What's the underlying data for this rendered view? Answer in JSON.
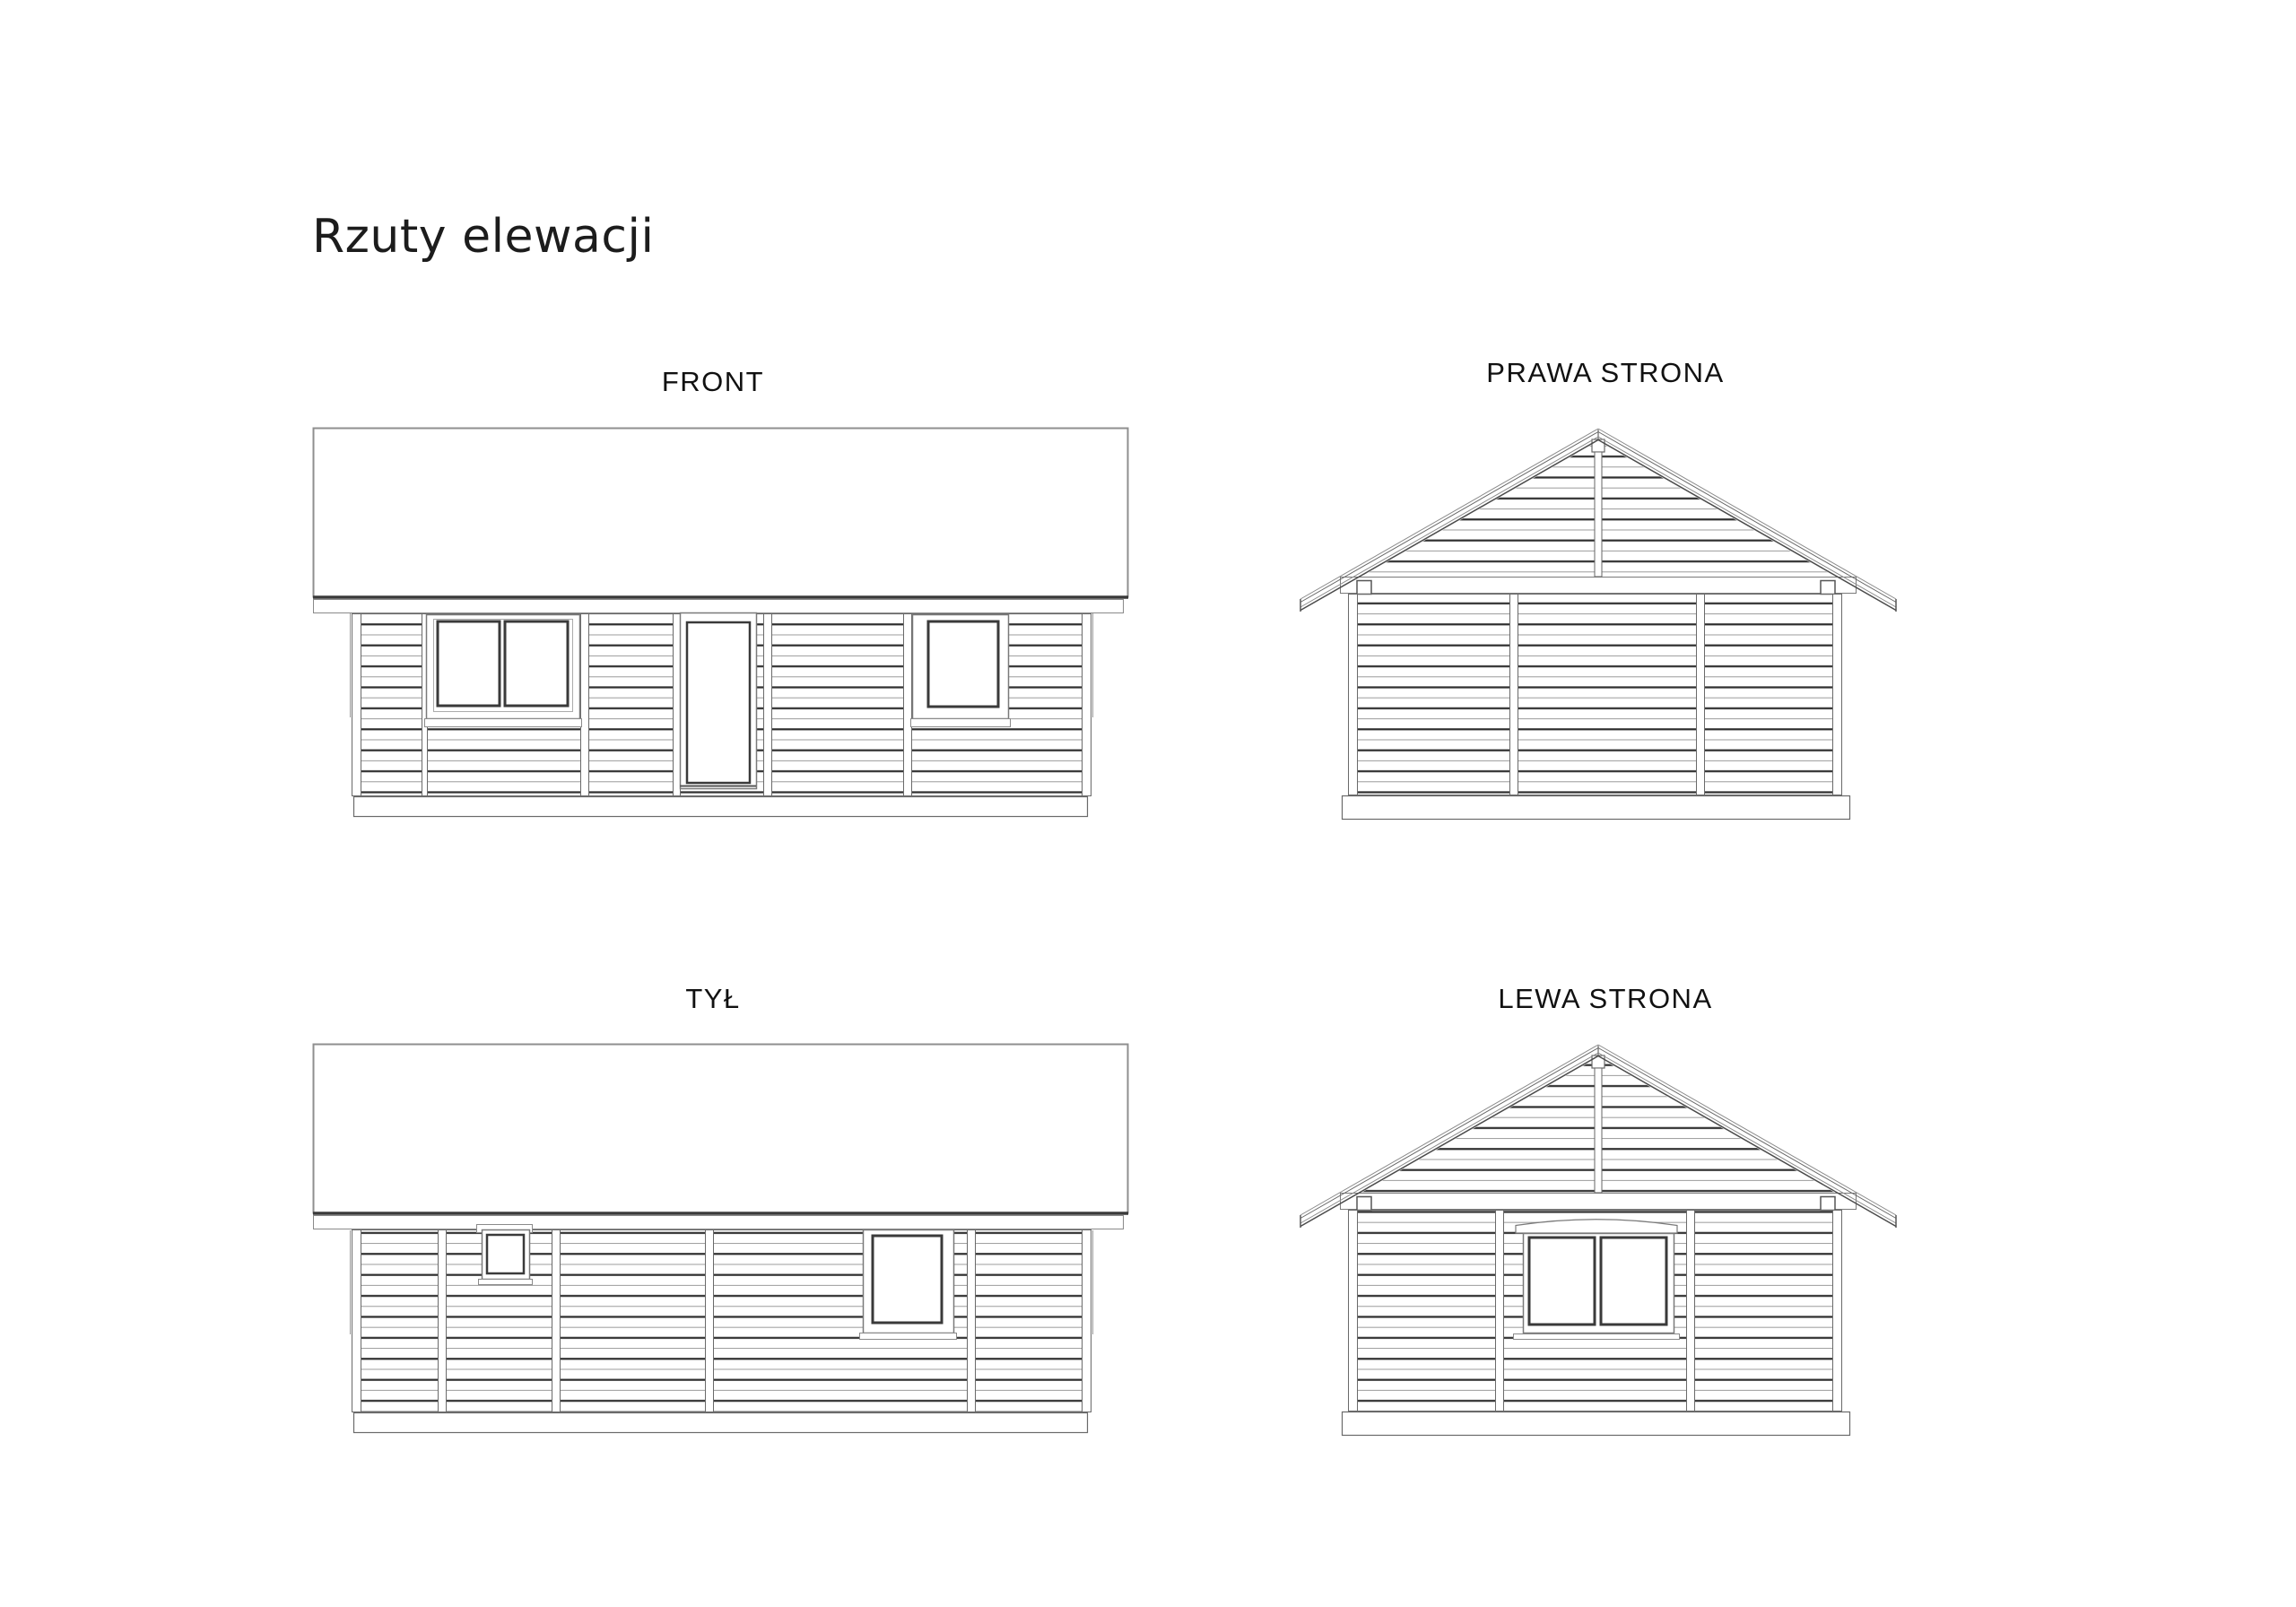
{
  "page": {
    "title": "Rzuty elewacji",
    "background_color": "#ffffff",
    "line_color_dark": "#303030",
    "line_color_light": "#9b9b9b"
  },
  "views": {
    "front": {
      "label": "FRONT"
    },
    "right": {
      "label": "PRAWA STRONA"
    },
    "back": {
      "label": "TYŁ"
    },
    "left": {
      "label": "LEWA STRONA"
    }
  }
}
